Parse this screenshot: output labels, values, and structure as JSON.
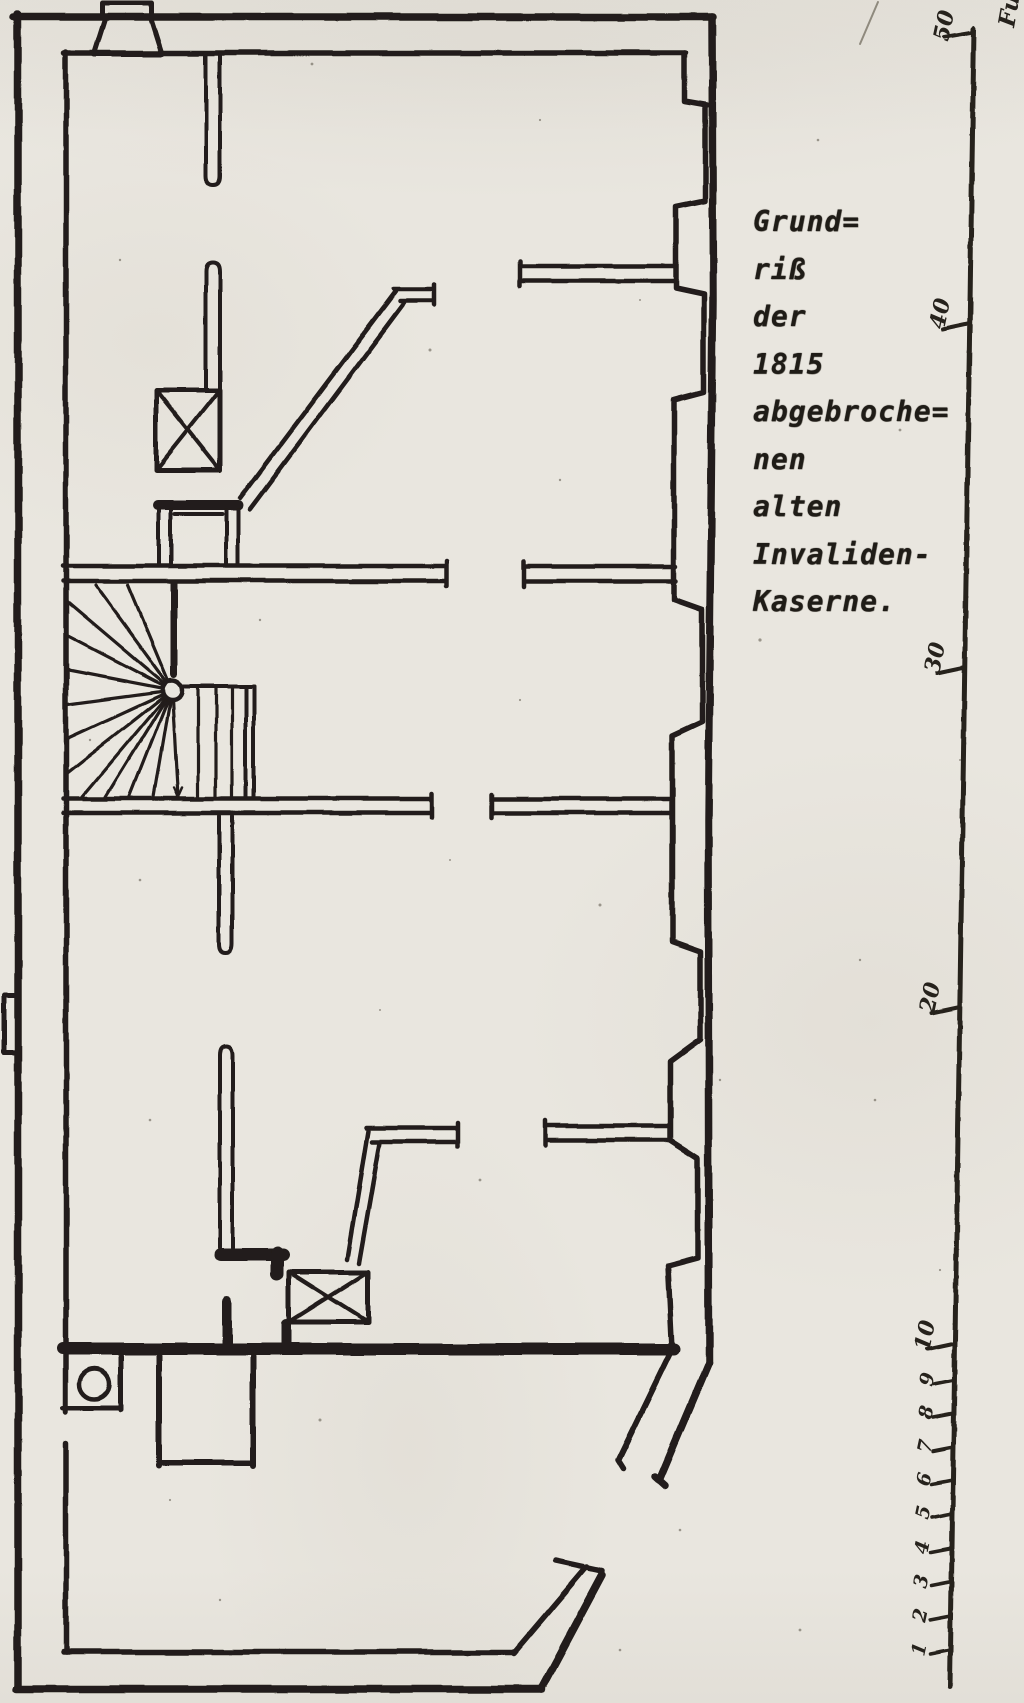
{
  "caption": {
    "lines": [
      "Grund=",
      "riß",
      "der",
      "1815",
      "abgebroche=",
      "nen",
      "alten",
      "Invaliden-",
      "Kaserne."
    ],
    "full_text": "Grundriß der 1815 abgebrochenen alten Invaliden-Kaserne."
  },
  "scale": {
    "unit_label": "Fuß",
    "major_labels": [
      "50",
      "40",
      "30",
      "20",
      "10"
    ],
    "minor_labels": [
      "9",
      "8",
      "7",
      "6",
      "5",
      "4",
      "3",
      "2",
      "1"
    ]
  },
  "colors": {
    "ink": "#221f1a",
    "paper": "#e9e6df"
  },
  "plan": {
    "elements": [
      "outer-wall",
      "inner-wall",
      "right-wall-niches",
      "partition-walls",
      "spiral-staircase",
      "straight-stair-upper",
      "straight-stair-lower",
      "chimney-box-upper",
      "chimney-box-lower",
      "tiled-stove",
      "well-circle",
      "cellar-box",
      "wall-buttress",
      "measuring-scale"
    ]
  }
}
